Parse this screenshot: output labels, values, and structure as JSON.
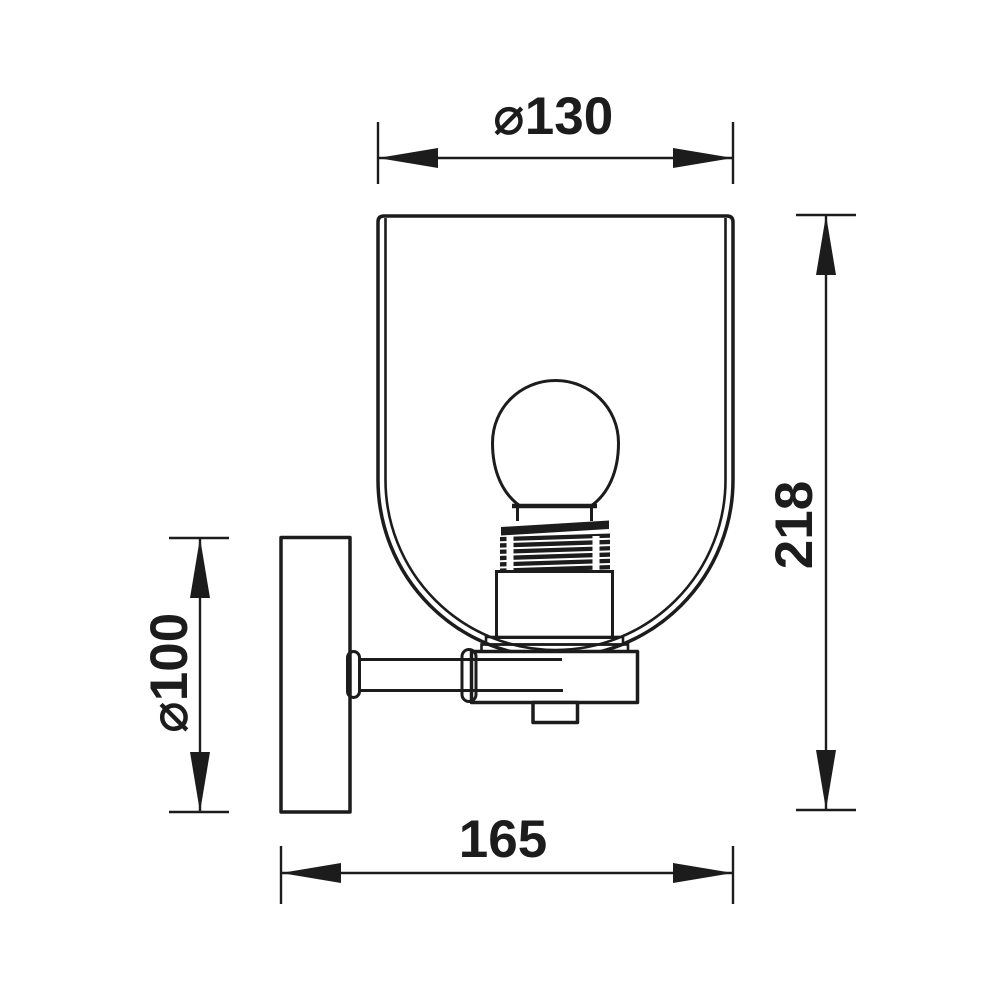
{
  "page": {
    "background": "#ffffff",
    "line_color": "#1c1c1c"
  },
  "drawing": {
    "subject": "Wall sconce light fixture — side elevation with dimensions",
    "labels": {
      "shade_diameter": "⌀130",
      "overall_height": "218",
      "backplate_diameter": "⌀100",
      "projection": "165"
    }
  }
}
